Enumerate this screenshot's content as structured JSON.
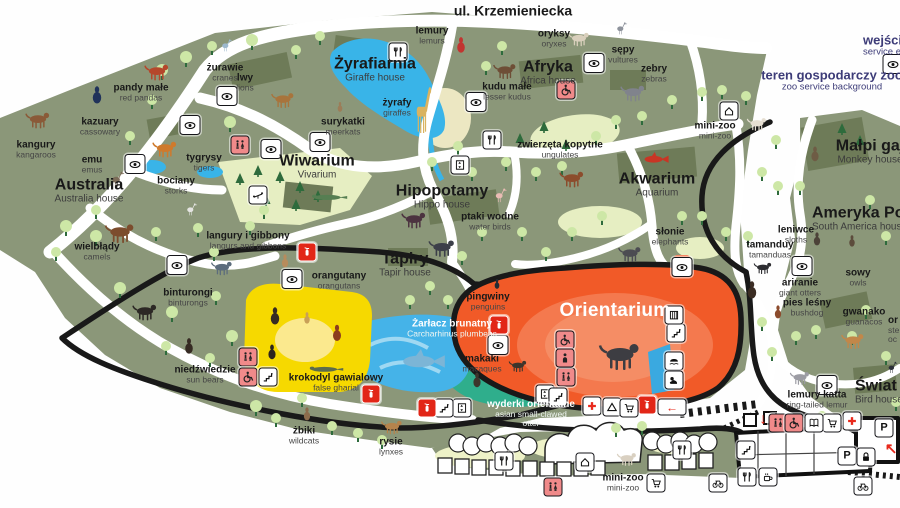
{
  "map": {
    "street": "ul. Krzemieniecka",
    "colors": {
      "grounds": "#8b9779",
      "lawn": "#e6eec2",
      "dark_patch": "#6e7b58",
      "water": "#39b4e8",
      "orientarium_orange": "#f15a28",
      "teal": "#2fae8c",
      "yellow_house": "#f6d900",
      "pink_icon": "#f08a8a",
      "red_icon": "#e22617",
      "navy_text": "#3d3c78",
      "tree": "#cde7a6"
    },
    "labels": [
      {
        "k": "street",
        "pl": "ul. Krzemieniecka",
        "x": 513,
        "y": 11
      },
      {
        "k": "note",
        "pl": "wejście s",
        "en": "service en",
        "x": 863,
        "y": 45,
        "left": true
      },
      {
        "k": "note",
        "pl": "teren gospodarczy zoo",
        "en": "zoo service background",
        "x": 832,
        "y": 80
      },
      {
        "k": "a",
        "pl": "kangury",
        "en": "kangaroos",
        "x": 36,
        "y": 150
      },
      {
        "k": "a",
        "pl": "kazuary",
        "en": "cassowary",
        "x": 100,
        "y": 127
      },
      {
        "k": "a",
        "pl": "pandy małe",
        "en": "red pandas",
        "x": 141,
        "y": 93
      },
      {
        "k": "a",
        "pl": "żurawie",
        "en": "cranes",
        "x": 225,
        "y": 73
      },
      {
        "k": "a",
        "pl": "lwy",
        "en": "lions",
        "x": 245,
        "y": 83
      },
      {
        "k": "a",
        "pl": "emu",
        "en": "emus",
        "x": 92,
        "y": 165
      },
      {
        "k": "a",
        "pl": "tygrysy",
        "en": "tigers",
        "x": 204,
        "y": 163
      },
      {
        "k": "a",
        "pl": "bociany",
        "en": "storks",
        "x": 176,
        "y": 186
      },
      {
        "k": "A",
        "pl": "Australia",
        "en": "Australia house",
        "x": 89,
        "y": 191
      },
      {
        "k": "a",
        "pl": "wielbłądy",
        "en": "camels",
        "x": 97,
        "y": 252
      },
      {
        "k": "A",
        "pl": "Żyrafiarnia",
        "en": "Giraffe house",
        "x": 375,
        "y": 70
      },
      {
        "k": "a",
        "pl": "żyrafy",
        "en": "giraffes",
        "x": 397,
        "y": 108
      },
      {
        "k": "a",
        "pl": "surykatki",
        "en": "meerkats",
        "x": 343,
        "y": 127
      },
      {
        "k": "a",
        "pl": "lemury",
        "en": "lemurs",
        "x": 432,
        "y": 36
      },
      {
        "k": "A",
        "pl": "Afryka",
        "en": "Africa house",
        "x": 548,
        "y": 73
      },
      {
        "k": "a",
        "pl": "oryksy",
        "en": "oryxes",
        "x": 554,
        "y": 39
      },
      {
        "k": "a",
        "pl": "kudu małe",
        "en": "lesser kudus",
        "x": 507,
        "y": 92
      },
      {
        "k": "a",
        "pl": "zwierzęta kopytne",
        "en": "ungulates",
        "x": 560,
        "y": 150
      },
      {
        "k": "a",
        "pl": "sępy",
        "en": "vultures",
        "x": 623,
        "y": 55
      },
      {
        "k": "a",
        "pl": "zebry",
        "en": "zebras",
        "x": 654,
        "y": 74
      },
      {
        "k": "a",
        "pl": "mini-zoo",
        "en": "mini-zoo",
        "x": 715,
        "y": 131
      },
      {
        "k": "A",
        "pl": "Małpi gaj",
        "en": "Monkey house",
        "x": 870,
        "y": 152
      },
      {
        "k": "A",
        "pl": "Wiwarium",
        "en": "Vivarium",
        "x": 317,
        "y": 167
      },
      {
        "k": "A",
        "pl": "Hipopotamy",
        "en": "Hippo house",
        "x": 442,
        "y": 197
      },
      {
        "k": "a",
        "pl": "ptaki wodne",
        "en": "water birds",
        "x": 490,
        "y": 222
      },
      {
        "k": "A",
        "pl": "Akwarium",
        "en": "Aquarium",
        "x": 657,
        "y": 185
      },
      {
        "k": "a",
        "pl": "słonie",
        "en": "elephants",
        "x": 670,
        "y": 237
      },
      {
        "k": "A",
        "pl": "Tapiry",
        "en": "Tapir house",
        "x": 405,
        "y": 265
      },
      {
        "k": "a",
        "pl": "langury i gibbony",
        "en": "langurs and gibbons",
        "x": 248,
        "y": 241
      },
      {
        "k": "a",
        "pl": "orangutany",
        "en": "orangutans",
        "x": 339,
        "y": 281
      },
      {
        "k": "a",
        "pl": "binturongi",
        "en": "binturongs",
        "x": 188,
        "y": 298
      },
      {
        "k": "a",
        "pl": "niedźwiedzie",
        "en": "sun bears",
        "x": 205,
        "y": 375
      },
      {
        "k": "a",
        "pl": "krokodyl gawialowy",
        "en": "false gharial",
        "x": 336,
        "y": 383
      },
      {
        "k": "a light",
        "pl": "Żarłacz brunatny",
        "en": "Carcharhinus plumbeus",
        "x": 452,
        "y": 329
      },
      {
        "k": "a",
        "pl": "pingwiny",
        "en": "penguins",
        "x": 488,
        "y": 302
      },
      {
        "k": "A big",
        "pl": "Orientarium",
        "x": 615,
        "y": 311
      },
      {
        "k": "a",
        "pl": "makaki",
        "en": "macaques",
        "x": 482,
        "y": 364
      },
      {
        "k": "a light",
        "pl": "wyderki orientalne",
        "en": "asian small-clawed\notter",
        "x": 531,
        "y": 414
      },
      {
        "k": "a",
        "pl": "żbiki",
        "en": "wildcats",
        "x": 304,
        "y": 436
      },
      {
        "k": "a",
        "pl": "rysie",
        "en": "lynxes",
        "x": 391,
        "y": 447
      },
      {
        "k": "A",
        "pl": "Ameryka Połud",
        "en": "South America house",
        "x": 812,
        "y": 219,
        "left": true
      },
      {
        "k": "a",
        "pl": "leniwce",
        "en": "sloths",
        "x": 796,
        "y": 235
      },
      {
        "k": "a",
        "pl": "tamanduy",
        "en": "tamanduas",
        "x": 770,
        "y": 250
      },
      {
        "k": "a",
        "pl": "sowy",
        "en": "owls",
        "x": 858,
        "y": 278
      },
      {
        "k": "a",
        "pl": "ariranie",
        "en": "giant otters",
        "x": 800,
        "y": 288
      },
      {
        "k": "a",
        "pl": "pies leśny",
        "en": "bushdog",
        "x": 807,
        "y": 308
      },
      {
        "k": "a",
        "pl": "gwanako",
        "en": "guanacos",
        "x": 864,
        "y": 317
      },
      {
        "k": "a",
        "pl": "or",
        "en": "ste\noc",
        "x": 888,
        "y": 330,
        "left": true
      },
      {
        "k": "a",
        "pl": "lemury katta",
        "en": "ring-tailed lemur",
        "x": 817,
        "y": 400
      },
      {
        "k": "A",
        "pl": "Świat p",
        "en": "Bird house",
        "x": 855,
        "y": 392,
        "left": true
      },
      {
        "k": "a",
        "pl": "mini-zoo",
        "en": "mini-zoo",
        "x": 623,
        "y": 483
      }
    ],
    "icons": [
      {
        "t": "eye",
        "x": 135,
        "y": 164
      },
      {
        "t": "eye",
        "x": 190,
        "y": 125
      },
      {
        "t": "eye",
        "x": 227,
        "y": 96
      },
      {
        "t": "eye",
        "x": 271,
        "y": 149
      },
      {
        "t": "eye",
        "x": 320,
        "y": 142
      },
      {
        "t": "eye",
        "x": 476,
        "y": 102
      },
      {
        "t": "eye",
        "x": 594,
        "y": 63
      },
      {
        "t": "eye",
        "x": 893,
        "y": 64
      },
      {
        "t": "eye",
        "x": 177,
        "y": 265
      },
      {
        "t": "eye",
        "x": 292,
        "y": 279
      },
      {
        "t": "eye",
        "x": 498,
        "y": 345
      },
      {
        "t": "eye",
        "x": 682,
        "y": 267
      },
      {
        "t": "eye",
        "x": 802,
        "y": 266
      },
      {
        "t": "eye",
        "x": 827,
        "y": 385
      },
      {
        "t": "fork",
        "x": 398,
        "y": 52
      },
      {
        "t": "fork",
        "x": 492,
        "y": 140
      },
      {
        "t": "fork",
        "x": 504,
        "y": 461
      },
      {
        "t": "fork",
        "x": 682,
        "y": 450
      },
      {
        "t": "fork",
        "x": 747,
        "y": 477
      },
      {
        "t": "wc",
        "x": 240,
        "y": 145,
        "v": "p"
      },
      {
        "t": "wc",
        "x": 248,
        "y": 357,
        "v": "p"
      },
      {
        "t": "wc",
        "x": 553,
        "y": 487,
        "v": "p"
      },
      {
        "t": "wc",
        "x": 778,
        "y": 423,
        "v": "p"
      },
      {
        "t": "wc",
        "x": 566,
        "y": 377,
        "v": "p"
      },
      {
        "t": "wheel",
        "x": 566,
        "y": 90,
        "v": "p"
      },
      {
        "t": "wheel",
        "x": 248,
        "y": 377,
        "v": "p"
      },
      {
        "t": "wheel",
        "x": 794,
        "y": 423,
        "v": "p"
      },
      {
        "t": "wheel",
        "x": 565,
        "y": 340,
        "v": "p"
      },
      {
        "t": "person",
        "x": 565,
        "y": 358,
        "v": "p"
      },
      {
        "t": "play",
        "x": 258,
        "y": 195
      },
      {
        "t": "lift",
        "x": 460,
        "y": 165
      },
      {
        "t": "lift",
        "x": 462,
        "y": 408
      },
      {
        "t": "lift",
        "x": 545,
        "y": 394
      },
      {
        "t": "stairs",
        "x": 268,
        "y": 377
      },
      {
        "t": "stairs",
        "x": 444,
        "y": 408
      },
      {
        "t": "stairs",
        "x": 558,
        "y": 397
      },
      {
        "t": "stairs",
        "x": 676,
        "y": 333
      },
      {
        "t": "stairs",
        "x": 746,
        "y": 450
      },
      {
        "t": "house",
        "x": 729,
        "y": 111
      },
      {
        "t": "house",
        "x": 585,
        "y": 462
      },
      {
        "t": "gate",
        "x": 674,
        "y": 315
      },
      {
        "t": "hippoic",
        "x": 674,
        "y": 361
      },
      {
        "t": "seal",
        "x": 674,
        "y": 380
      },
      {
        "t": "ext",
        "x": 307,
        "y": 252,
        "v": "r"
      },
      {
        "t": "ext",
        "x": 371,
        "y": 394,
        "v": "r"
      },
      {
        "t": "ext",
        "x": 427,
        "y": 408,
        "v": "r"
      },
      {
        "t": "ext",
        "x": 499,
        "y": 325,
        "v": "r"
      },
      {
        "t": "ext",
        "x": 647,
        "y": 405,
        "v": "r"
      },
      {
        "t": "aid",
        "x": 592,
        "y": 406
      },
      {
        "t": "aid",
        "x": 852,
        "y": 421
      },
      {
        "t": "tent",
        "x": 612,
        "y": 407
      },
      {
        "t": "cart",
        "x": 629,
        "y": 408
      },
      {
        "t": "cart",
        "x": 832,
        "y": 423
      },
      {
        "t": "cart",
        "x": 656,
        "y": 483
      },
      {
        "t": "book",
        "x": 814,
        "y": 423
      },
      {
        "t": "park",
        "x": 847,
        "y": 456
      },
      {
        "t": "park",
        "x": 884,
        "y": 428
      },
      {
        "t": "lock",
        "x": 866,
        "y": 457
      },
      {
        "t": "bike",
        "x": 718,
        "y": 483
      },
      {
        "t": "bike",
        "x": 863,
        "y": 486
      },
      {
        "t": "cafe",
        "x": 768,
        "y": 477
      },
      {
        "t": "aleft",
        "x": 672,
        "y": 407,
        "v": "wide"
      },
      {
        "t": "adown",
        "x": 763,
        "y": 419,
        "v": "b"
      },
      {
        "t": "aup",
        "x": 891,
        "y": 449,
        "v": "b"
      }
    ],
    "animals": [
      {
        "n": "kangaroo",
        "kind": "quad",
        "c": "#8a5a38",
        "x": 38,
        "y": 120,
        "w": 30
      },
      {
        "n": "cassowary",
        "kind": "blob",
        "c": "#20325a",
        "x": 97,
        "y": 95,
        "w": 20
      },
      {
        "n": "red-panda",
        "kind": "quad",
        "c": "#b5472b",
        "x": 157,
        "y": 72,
        "w": 30
      },
      {
        "n": "crane",
        "kind": "bird",
        "c": "#9db9ce",
        "x": 226,
        "y": 46,
        "w": 18
      },
      {
        "n": "emu",
        "kind": "bird",
        "c": "#7b6c58",
        "x": 117,
        "y": 180,
        "w": 22
      },
      {
        "n": "lion",
        "kind": "quad",
        "c": "#a8743c",
        "x": 283,
        "y": 100,
        "w": 28
      },
      {
        "n": "tiger",
        "kind": "quad",
        "c": "#cf7a2c",
        "x": 165,
        "y": 149,
        "w": 30
      },
      {
        "n": "stork",
        "kind": "bird",
        "c": "#e5e5e2",
        "x": 191,
        "y": 210,
        "w": 18
      },
      {
        "n": "camel",
        "kind": "quad",
        "c": "#7c4c2d",
        "x": 120,
        "y": 233,
        "w": 36
      },
      {
        "n": "giraffe",
        "kind": "gir",
        "c": "#d9b360",
        "x": 423,
        "y": 110,
        "w": 24
      },
      {
        "n": "meerkat",
        "kind": "blob",
        "c": "#9c7d58",
        "x": 340,
        "y": 107,
        "w": 11
      },
      {
        "n": "ruffed-lemur",
        "kind": "blob",
        "c": "#c23430",
        "x": 461,
        "y": 45,
        "w": 18
      },
      {
        "n": "kudu",
        "kind": "quad",
        "c": "#6e4e36",
        "x": 505,
        "y": 71,
        "w": 28
      },
      {
        "n": "oryx",
        "kind": "quad",
        "c": "#d9cfbc",
        "x": 579,
        "y": 39,
        "w": 26
      },
      {
        "n": "vulture",
        "kind": "bird",
        "c": "#8e939c",
        "x": 621,
        "y": 29,
        "w": 18
      },
      {
        "n": "zebra",
        "kind": "quad",
        "c": "#80838c",
        "x": 633,
        "y": 93,
        "w": 30
      },
      {
        "n": "goat",
        "kind": "quad",
        "c": "#e6dfd2",
        "x": 757,
        "y": 124,
        "w": 24
      },
      {
        "n": "monkey",
        "kind": "blob",
        "c": "#6e5c45",
        "x": 815,
        "y": 154,
        "w": 17
      },
      {
        "n": "red-fish",
        "kind": "fish",
        "c": "#c93524",
        "x": 656,
        "y": 159,
        "w": 30
      },
      {
        "n": "deer",
        "kind": "quad",
        "c": "#8c4c2c",
        "x": 572,
        "y": 179,
        "w": 30
      },
      {
        "n": "hippo",
        "kind": "quad",
        "c": "#4c3340",
        "x": 414,
        "y": 220,
        "w": 30
      },
      {
        "n": "spoonbill",
        "kind": "bird",
        "c": "#eabcb4",
        "x": 500,
        "y": 196,
        "w": 20
      },
      {
        "n": "tapir",
        "kind": "quad",
        "c": "#3c3f49",
        "x": 442,
        "y": 248,
        "w": 32
      },
      {
        "n": "elephant-large",
        "kind": "quad",
        "c": "#3d3d42",
        "x": 620,
        "y": 356,
        "w": 50
      },
      {
        "n": "elephant-small",
        "kind": "quad",
        "c": "#4c4c52",
        "x": 630,
        "y": 254,
        "w": 28
      },
      {
        "n": "monitor-lizard",
        "kind": "croc",
        "c": "#567e52",
        "x": 328,
        "y": 196,
        "w": 40
      },
      {
        "n": "langur",
        "kind": "quad",
        "c": "#5c6c7c",
        "x": 222,
        "y": 268,
        "w": 26
      },
      {
        "n": "gibbon",
        "kind": "blob",
        "c": "#b78c5c",
        "x": 285,
        "y": 261,
        "w": 15
      },
      {
        "n": "binturong",
        "kind": "quad",
        "c": "#2c2825",
        "x": 145,
        "y": 312,
        "w": 30
      },
      {
        "n": "sun-bear",
        "kind": "blob",
        "c": "#362b23",
        "x": 189,
        "y": 346,
        "w": 18
      },
      {
        "n": "sun-bear-2",
        "kind": "blob",
        "c": "#362b23",
        "x": 275,
        "y": 316,
        "w": 20
      },
      {
        "n": "monkey-tan",
        "kind": "blob",
        "c": "#c9a058",
        "x": 307,
        "y": 318,
        "w": 13
      },
      {
        "n": "orangutan",
        "kind": "blob",
        "c": "#8c3d1e",
        "x": 337,
        "y": 333,
        "w": 19
      },
      {
        "n": "dark-monkey",
        "kind": "blob",
        "c": "#2c241e",
        "x": 272,
        "y": 352,
        "w": 17
      },
      {
        "n": "false-gharial",
        "kind": "croc",
        "c": "#5c6c4c",
        "x": 325,
        "y": 368,
        "w": 38
      },
      {
        "n": "shark",
        "kind": "fish",
        "c": "#7cb5d6",
        "x": 423,
        "y": 361,
        "w": 52
      },
      {
        "n": "penguin",
        "kind": "blob",
        "c": "#232b34",
        "x": 497,
        "y": 284,
        "w": 11
      },
      {
        "n": "macaque",
        "kind": "blob",
        "c": "#3d352c",
        "x": 477,
        "y": 380,
        "w": 17
      },
      {
        "n": "otter",
        "kind": "quad",
        "c": "#3d352c",
        "x": 518,
        "y": 366,
        "w": 22
      },
      {
        "n": "wildcat",
        "kind": "blob",
        "c": "#8c6c4c",
        "x": 307,
        "y": 414,
        "w": 15
      },
      {
        "n": "lynx",
        "kind": "quad",
        "c": "#b5834c",
        "x": 392,
        "y": 427,
        "w": 26
      },
      {
        "n": "sloth",
        "kind": "blob",
        "c": "#4c4238",
        "x": 817,
        "y": 239,
        "w": 15
      },
      {
        "n": "tamandua",
        "kind": "quad",
        "c": "#2d2d31",
        "x": 763,
        "y": 268,
        "w": 22
      },
      {
        "n": "owl",
        "kind": "blob",
        "c": "#5c4c3c",
        "x": 852,
        "y": 241,
        "w": 13
      },
      {
        "n": "giant-otter",
        "kind": "blob",
        "c": "#3b2d24",
        "x": 752,
        "y": 290,
        "w": 20
      },
      {
        "n": "bushdog",
        "kind": "blob",
        "c": "#8c4c2d",
        "x": 778,
        "y": 312,
        "w": 15
      },
      {
        "n": "guanaco",
        "kind": "quad",
        "c": "#c28749",
        "x": 853,
        "y": 341,
        "w": 28
      },
      {
        "n": "ring-tailed-lemur",
        "kind": "quad",
        "c": "#9c9ca4",
        "x": 800,
        "y": 378,
        "w": 24
      },
      {
        "n": "dark-bird",
        "kind": "bird",
        "c": "#2c3038",
        "x": 892,
        "y": 368,
        "w": 16
      },
      {
        "n": "goat-2",
        "kind": "quad",
        "c": "#d9d0c1",
        "x": 627,
        "y": 459,
        "w": 24
      }
    ]
  }
}
